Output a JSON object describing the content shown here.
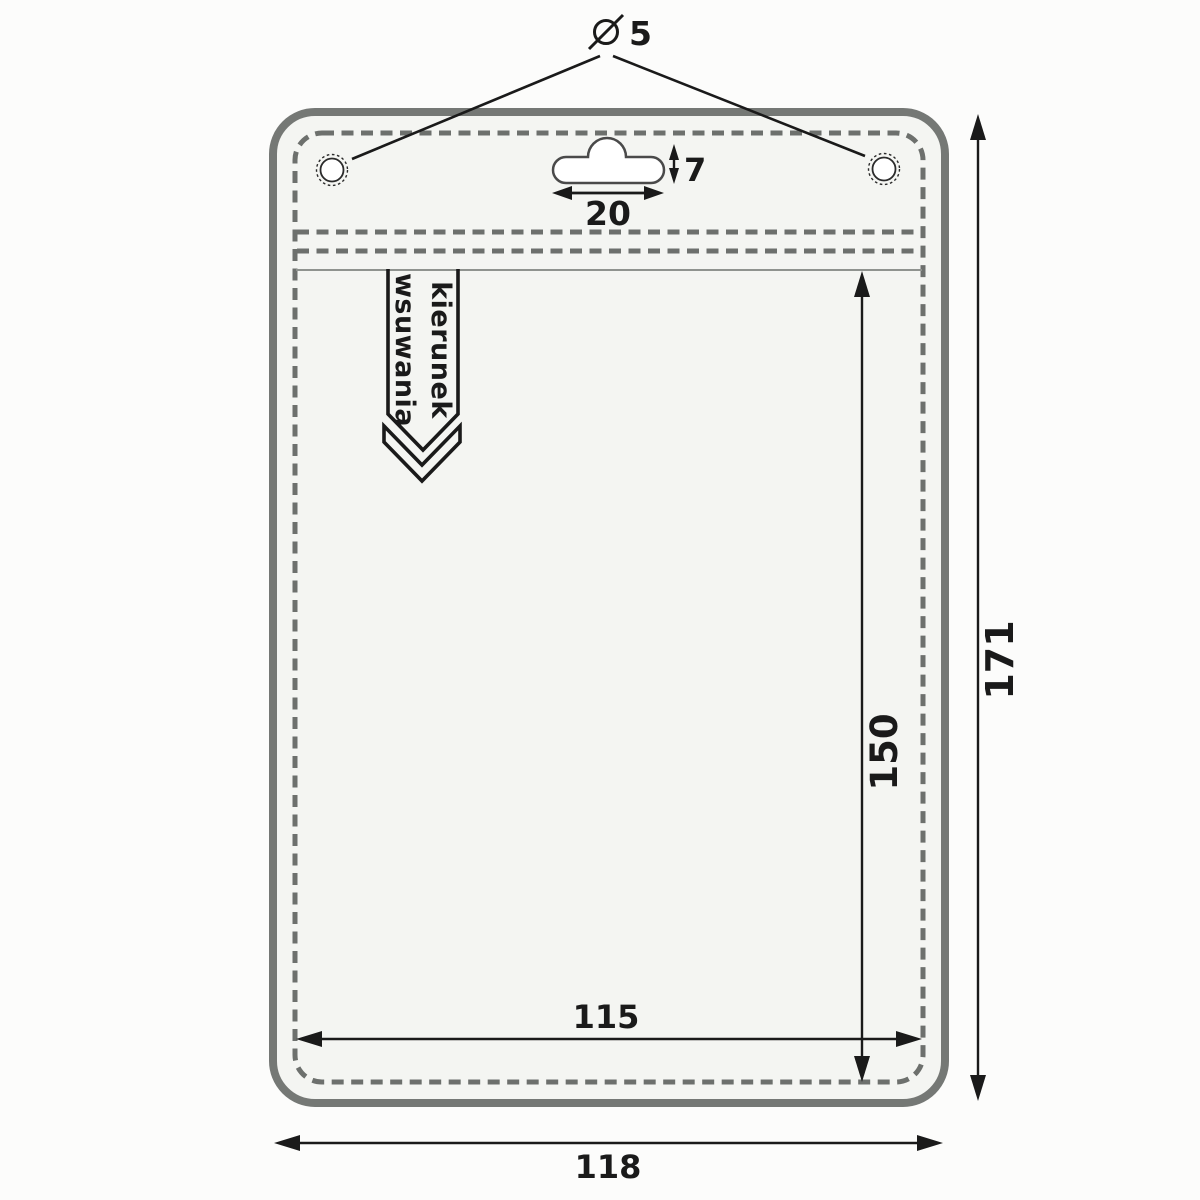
{
  "colors": {
    "ink": "#1a1a1a",
    "outline_gray": "#757875",
    "dash_gray": "#6d706d",
    "holder_fill": "#f4f5f2",
    "page_background": "#fcfcfb"
  },
  "callout": {
    "diameter_symbol": "Ø",
    "diameter_value": "5"
  },
  "euro_slot": {
    "height_label": "7",
    "width_label": "20"
  },
  "insertion_arrow": {
    "line1": "kierunek",
    "line2": "wsuwania"
  },
  "dimensions": {
    "pocket_height": "150",
    "overall_height": "171",
    "pocket_width": "115",
    "overall_width": "118"
  }
}
